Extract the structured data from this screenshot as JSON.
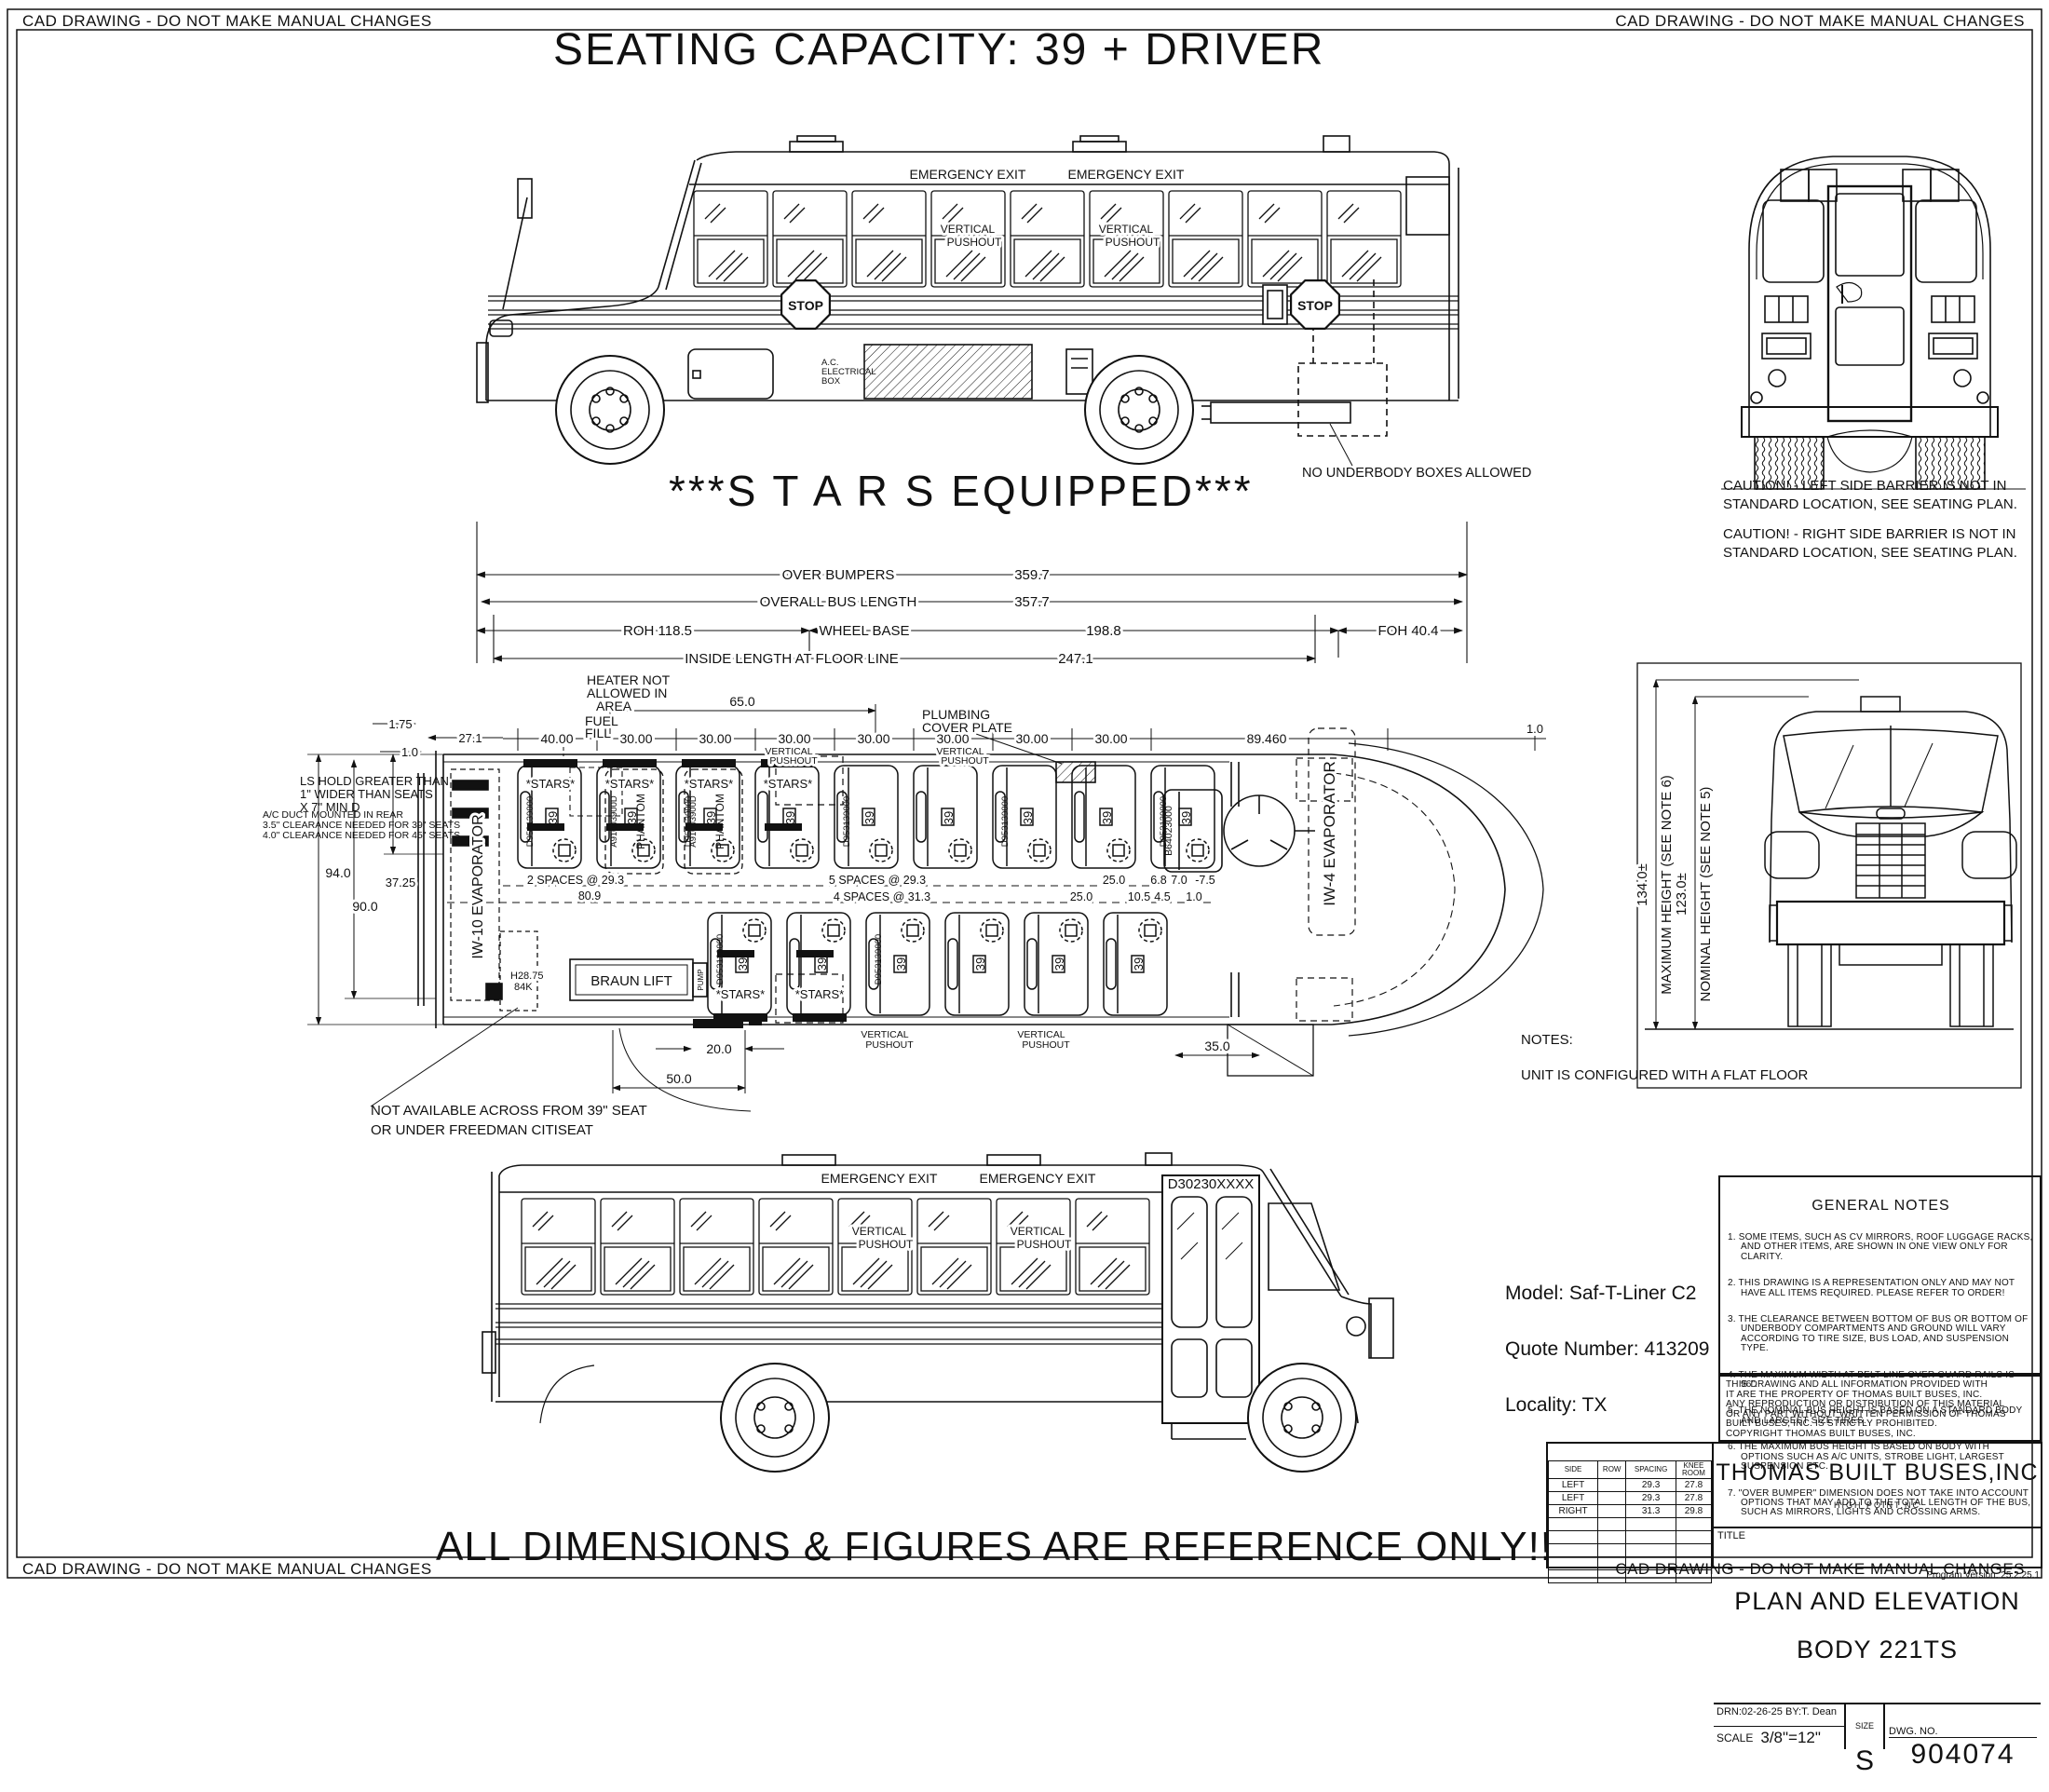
{
  "frame": {
    "corner_note": "CAD DRAWING - DO NOT MAKE MANUAL CHANGES"
  },
  "header": {
    "title": "SEATING CAPACITY: 39 + DRIVER"
  },
  "banners": {
    "stars": "***S T A R S   EQUIPPED***",
    "reference": "ALL DIMENSIONS & FIGURES ARE REFERENCE ONLY!!"
  },
  "labels": {
    "emergency_exit": "EMERGENCY EXIT",
    "vertical": "VERTICAL",
    "pushout": "PUSHOUT",
    "stop": "STOP",
    "ac_line1": "A.C.",
    "ac_line2": "ELECTRICAL",
    "ac_line3": "BOX",
    "no_underbody": "NO UNDERBODY BOXES ALLOWED",
    "door_part": "D30230XXXX"
  },
  "rear_view": {
    "caution_left": "CAUTION! - LEFT SIDE BARRIER IS NOT IN\nSTANDARD LOCATION, SEE SEATING PLAN.",
    "caution_right": "CAUTION! - RIGHT SIDE BARRIER IS NOT IN\nSTANDARD LOCATION, SEE SEATING PLAN."
  },
  "dims": {
    "over_bumpers": "OVER BUMPERS",
    "over_bumpers_val": "359.7",
    "overall": "OVERALL BUS LENGTH",
    "overall_val": "357.7",
    "roh": "ROH   118.5",
    "wheel_base": "WHEEL BASE",
    "wheel_base_val": "198.8",
    "foh": "FOH   40.4",
    "inside": "INSIDE LENGTH AT FLOOR LINE",
    "inside_val": "247.1",
    "d175": "1.75",
    "d271": "27.1",
    "d10": "1.0",
    "d65": "65.0",
    "d40": "40.00",
    "d30": "30.00",
    "d89": "89.460",
    "d94": "94.0",
    "d3725": "37.25",
    "d90": "90.0",
    "d2875": "H28.75",
    "d84k": "84K",
    "sp2": "2 SPACES @ 29.3",
    "d809": "80.9",
    "sp5": "5 SPACES @ 29.3",
    "sp4": "4 SPACES @ 31.3",
    "d25": "25.0",
    "d68": "6.8",
    "d70": "7.0",
    "dm75": "-7.5",
    "d105": "10.5",
    "d45": "4.5",
    "d20": "20.0",
    "d50": "50.0",
    "d35": "35.0"
  },
  "plan": {
    "heater1": "HEATER NOT",
    "heater2": "ALLOWED IN",
    "heater3": "AREA",
    "fuel1": "FUEL",
    "fuel2": "FILL",
    "plumbing1": "PLUMBING",
    "plumbing2": "COVER PLATE",
    "evap_left": "IW-10 EVAPORATOR",
    "evap_right": "IW-4 EVAPORATOR",
    "braun": "BRAUN LIFT",
    "pump": "PUMP",
    "stars": "*STARS*",
    "seat": "39",
    "phantom": "PHANTOM",
    "part_seat": "D953139000",
    "part_phantom": "A91003900D",
    "part_driver": "B64023000",
    "note_hold": "LS HOLD GREATER THAN\n1\" WIDER THAN SEATS\nX 7\" MIN D",
    "note_duct": "A/C DUCT MOUNTED IN REAR\n3.5\" CLEARANCE NEEDED FOR 39\" SEATS\n4.0\" CLEARANCE NEEDED FOR 45\" SEATS",
    "lift_note": "NOT AVAILABLE ACROSS FROM 39\" SEAT\nOR UNDER FREEDMAN CITISEAT"
  },
  "front_view": {
    "max_val": "134.0±",
    "max_label": "MAXIMUM HEIGHT (SEE NOTE 6)",
    "nom_val": "123.0±",
    "nom_label": "NOMINAL HEIGHT (SEE NOTE 5)"
  },
  "notes": {
    "title": "NOTES:",
    "body": "UNIT IS CONFIGURED WITH A FLAT FLOOR"
  },
  "order_info": {
    "model": "Model: Saf-T-Liner C2",
    "quote": "Quote Number: 413209",
    "locality": "Locality: TX"
  },
  "general_notes": {
    "title": "GENERAL NOTES",
    "items": [
      "1. SOME ITEMS, SUCH AS CV MIRRORS, ROOF LUGGAGE RACKS, AND OTHER ITEMS, ARE SHOWN IN ONE VIEW ONLY FOR CLARITY.",
      "2. THIS DRAWING IS A REPRESENTATION ONLY AND MAY NOT HAVE ALL ITEMS REQUIRED. PLEASE REFER TO ORDER!",
      "3. THE CLEARANCE BETWEEN BOTTOM OF BUS OR BOTTOM OF UNDERBODY COMPARTMENTS AND GROUND WILL VARY ACCORDING TO TIRE SIZE, BUS LOAD, AND SUSPENSION TYPE.",
      "4. THE MAXIMUM WIDTH AT BELT LINE OVER GUARD RAILS IS 96\".",
      "5. THE NOMINAL BUS HEIGHT IS BASED ON A STANDARD BODY AND LARGEST SIZE TIRES.",
      "6. THE MAXIMUM BUS HEIGHT IS BASED ON BODY WITH OPTIONS SUCH AS A/C UNITS, STROBE LIGHT, LARGEST SUSPENSION ETC.",
      "7. \"OVER BUMPER\" DIMENSION DOES NOT TAKE INTO ACCOUNT OPTIONS THAT MAY ADD TO THE TOTAL LENGTH OF THE BUS, SUCH AS MIRRORS, LIGHTS AND CROSSING ARMS."
    ],
    "copyright": "THIS DRAWING AND ALL INFORMATION PROVIDED WITH\nIT ARE THE PROPERTY OF THOMAS BUILT BUSES, INC.\nANY REPRODUCTION OR DISTRIBUTION OF THIS MATERIAL\nOR ANY PART WITHOUT WRITTEN PERMISSION OF THOMAS\nBUILT BUSES, INC. IS  STRICTLY PROHIBITED.\nCOPYRIGHT THOMAS BUILT BUSES, INC."
  },
  "title_block": {
    "company": "THOMAS BUILT BUSES,INC",
    "location": "HIGH POINT,NC",
    "title_label": "TITLE",
    "title1": "PLAN AND ELEVATION",
    "title2": "BODY 221TS",
    "drn": "DRN:02-26-25    BY:T. Dean",
    "scale_label": "SCALE",
    "scale": "3/8\"=12\"",
    "size_label": "SIZE",
    "size": "S",
    "dwg_label": "DWG. NO.",
    "dwg": "904074",
    "version": "Program Version: 25.2.25.1",
    "seat_table": {
      "headers": [
        "SIDE",
        "ROW",
        "SPACING",
        "KNEE\nROOM"
      ],
      "rows": [
        [
          "LEFT",
          "",
          "29.3",
          "27.8"
        ],
        [
          "LEFT",
          "",
          "29.3",
          "27.8"
        ],
        [
          "RIGHT",
          "",
          "31.3",
          "29.8"
        ],
        [
          "",
          "",
          "",
          ""
        ],
        [
          "",
          "",
          "",
          ""
        ],
        [
          "",
          "",
          "",
          ""
        ],
        [
          "",
          "",
          "",
          ""
        ],
        [
          "",
          "",
          "",
          ""
        ]
      ]
    }
  }
}
